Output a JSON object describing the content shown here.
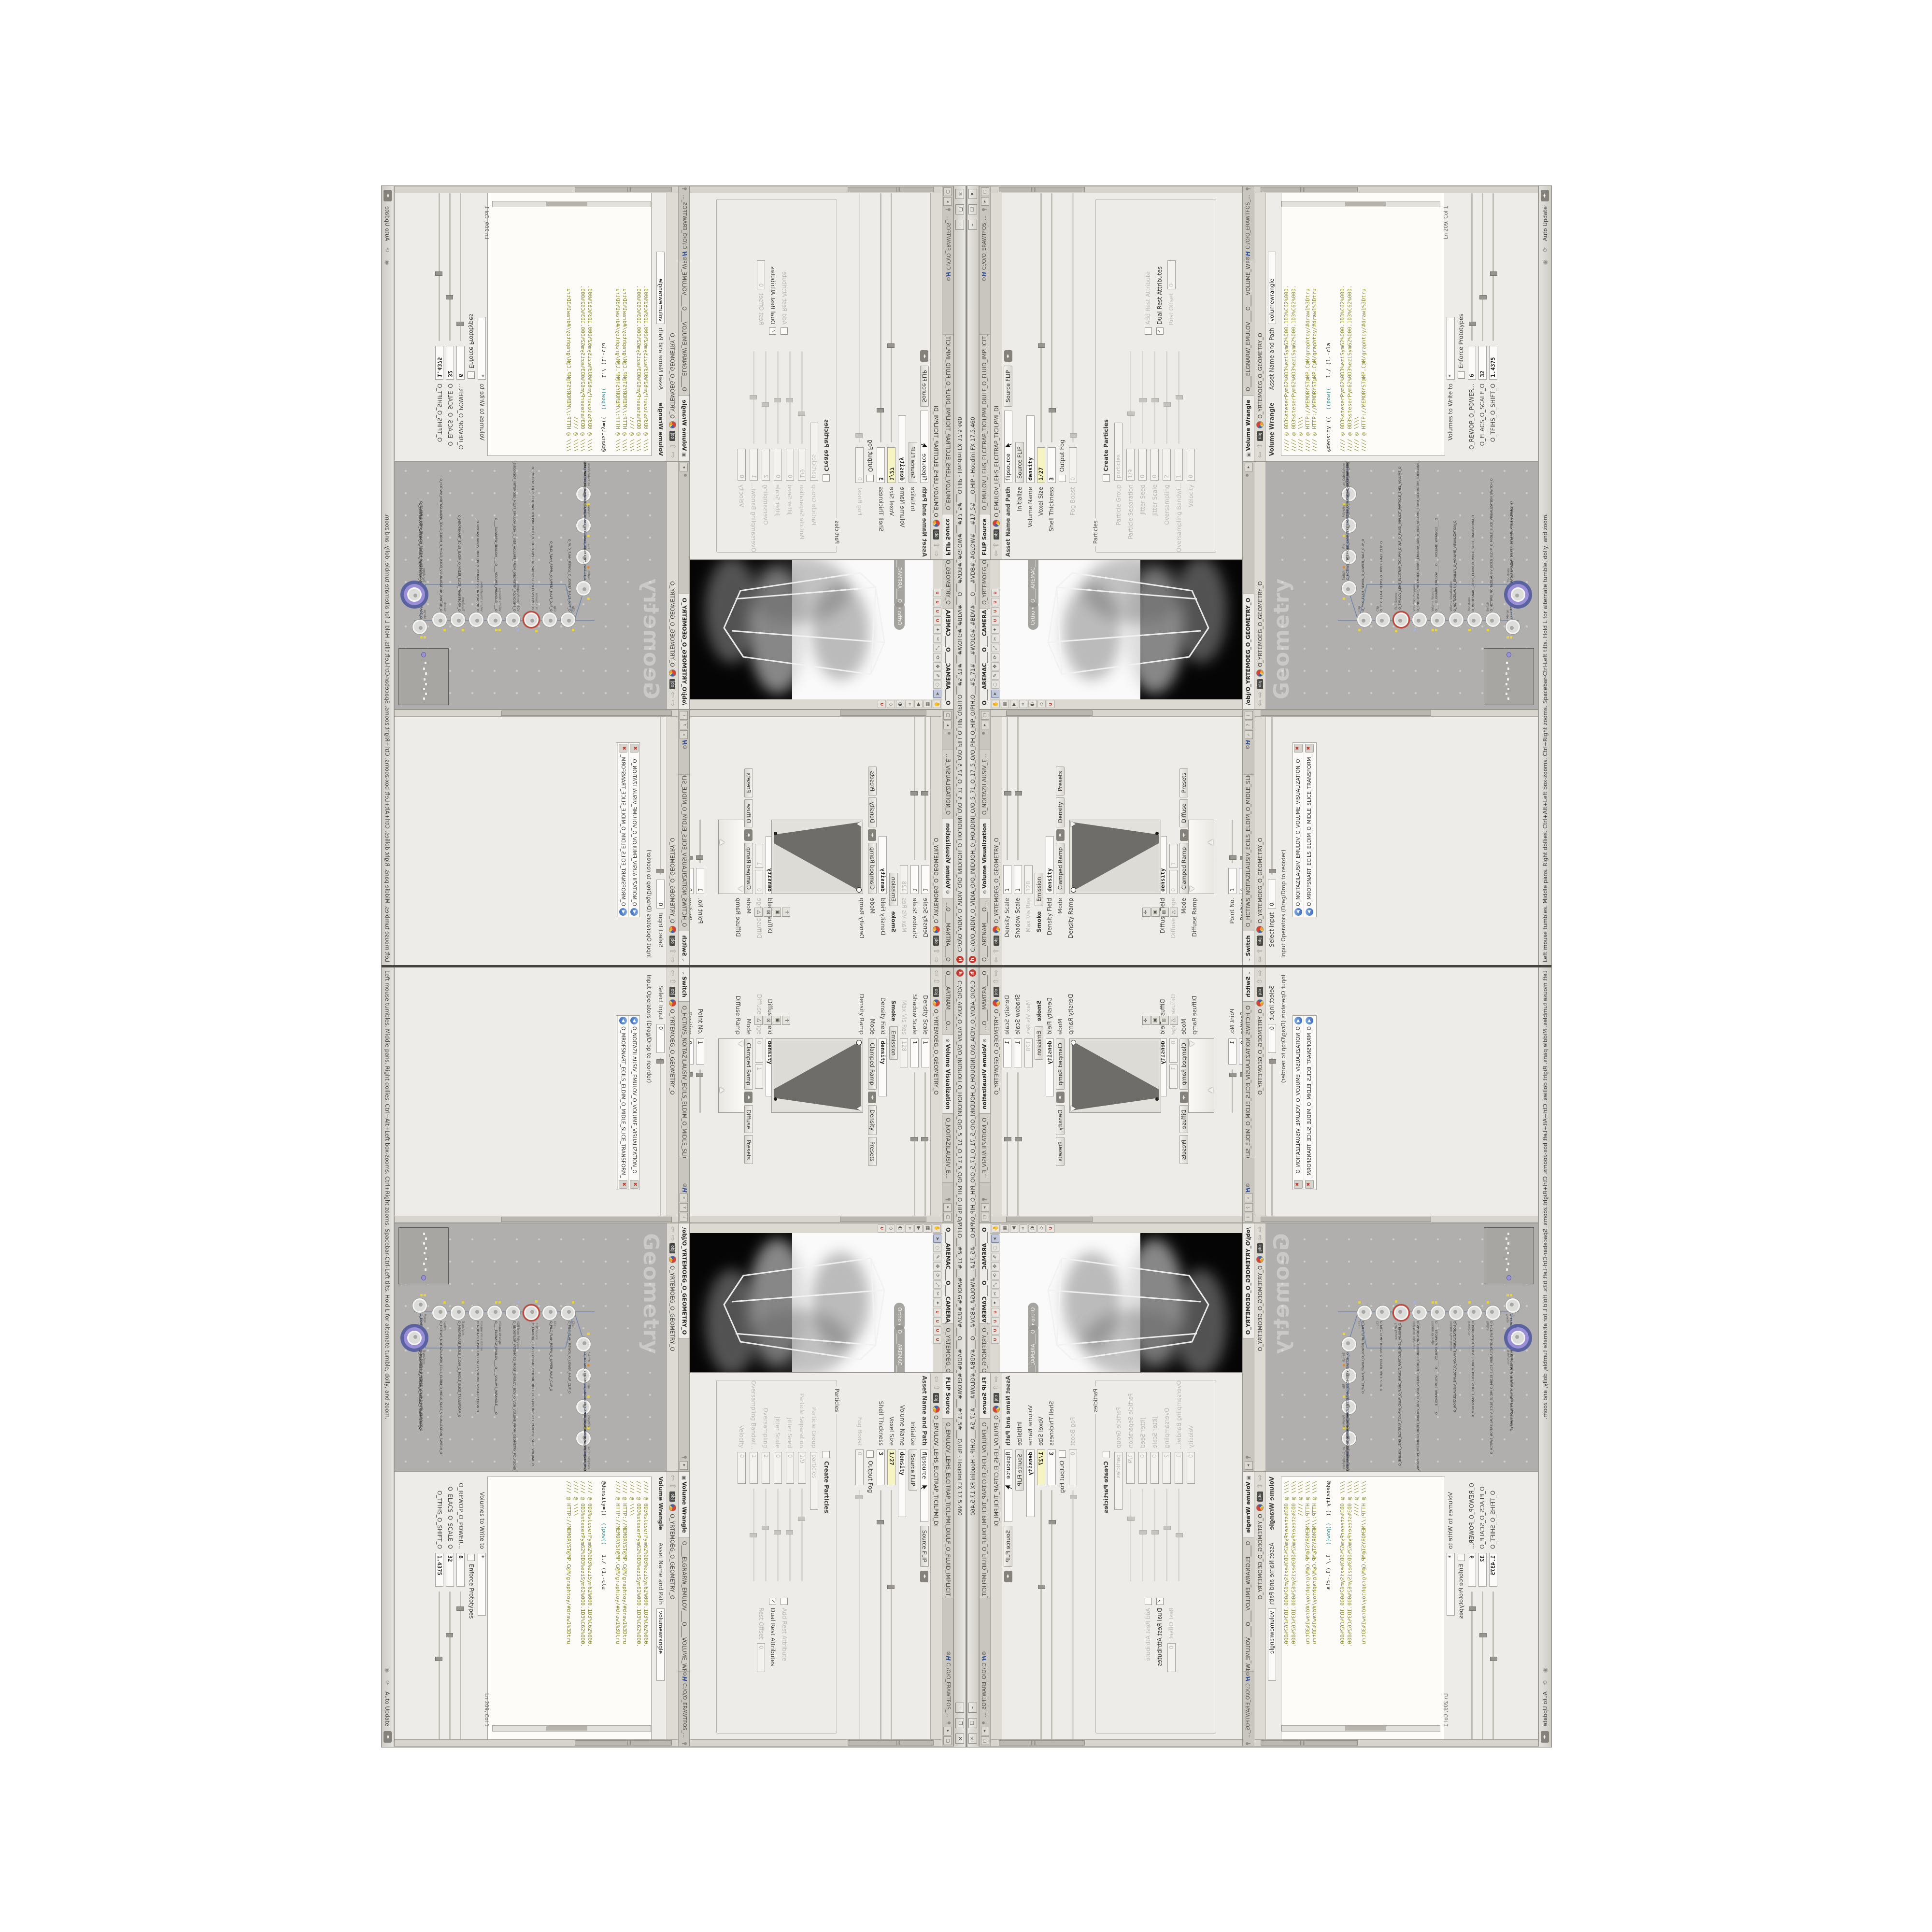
{
  "window": {
    "title": "C:/O/O_AIDIV_O_VIDIA_O/O_INIDUOH_O_HOUDINI_O/O_5_71_O_17_5_O/O_PIH_O_HIP_O/PIH.O___#5_71#___#WOLG#_#BDV#___O___#VDB#_#GLOW#___#17_5#___O.HIP - Houdini FX 17.5.460",
    "minimize": "–",
    "maximize": "❐",
    "close": "✕",
    "app_initial": "h"
  },
  "statusbar": {
    "hint": "Left mouse tumbles. Middle pans. Right dollies. Ctrl+Alt+Left box-zooms. Ctrl+Right zooms. Spacebar-Ctrl-Left tilts. Hold L for alternate tumble, dolly, and zoom.",
    "auto_update": "Auto Update"
  },
  "software_path": "C:/O/O_ERAWTFOS_...",
  "flip": {
    "tab": "FLIP Source",
    "tab2": "O_EMULOV_LEHS_ELCITRAP_TICILPMI_DIULF_O_FLUID_IMPLICIT_PARTICLE_SHEL_VOLUME_O",
    "ctx": "obj",
    "node": "O_EMULOV_LEHS_ELCITRAP_TICILPMI_DI",
    "asset_label": "Asset Name and Path",
    "asset_name": "flipsource",
    "asset_type": "Source FLIP",
    "rows": {
      "initialize": {
        "label": "Initialize",
        "value": "Source FLIP"
      },
      "volume_name": {
        "label": "Volume Name",
        "value": "density"
      },
      "voxel_size": {
        "label": "Voxel Size",
        "value": "1/27"
      },
      "shell_thickness": {
        "label": "Shell Thickness",
        "value": "3"
      },
      "output_fog": {
        "label": "Output Fog"
      },
      "fog_boost": {
        "label": "Fog Boost",
        "value": "0"
      }
    },
    "particles": {
      "title": "Particles",
      "create": "Create Particles",
      "group": {
        "label": "Particle Group",
        "value": "particles"
      },
      "separation": {
        "label": "Particle Separation",
        "value": "1/9"
      },
      "jitter_seed": {
        "label": "Jitter Seed",
        "value": "0"
      },
      "jitter_scale": {
        "label": "Jitter Scale",
        "value": "0"
      },
      "oversampling": {
        "label": "Oversampling",
        "value": "2"
      },
      "oversampling_bw": {
        "label": "Oversampling Bandwi...",
        "value": "1"
      },
      "velocity": {
        "label": "Velocity",
        "value": "0"
      },
      "rest_offset": {
        "label": "Rest Offset",
        "value": "0"
      },
      "add_rest": "Add Rest Attribute",
      "dual_rest": "Dual Rest Attributes"
    }
  },
  "viewport": {
    "tab": "O____AREMAC____O____CAMERA____O...",
    "tab2": "O_YRTEMOEG_O_GEOMETRY_O",
    "ortho_pill": "Ortho ▾",
    "cam_pill": "O____AREMAC____O..."
  },
  "volviz": {
    "tab_prev": "O____ARTNAM____O...",
    "tab": "Volume Visualization",
    "tab_next": "O_NOITAZILAUSIV_E...",
    "ctx": "obj",
    "node": "O_YRTEMOEG_O_GEOMETRY_O",
    "density_scale": {
      "label": "Density Scale",
      "value": "1"
    },
    "shadow_scale": {
      "label": "Shadow Scale",
      "value": "1"
    },
    "max_vis_res": {
      "label": "Max Vis Res",
      "value": "128"
    },
    "folder_tabs": {
      "smoke": "Smoke",
      "emission": "Emission"
    },
    "density_field": {
      "label": "Density Field",
      "value": "density"
    },
    "mode1": {
      "label": "Mode",
      "value": "Clamped Ramp",
      "chan": "Density",
      "presets": "Presets"
    },
    "density_ramp_label": "Density Ramp",
    "diffuse_field": {
      "label": "Diffuse Field",
      "value": "density"
    },
    "diffuse_range": {
      "label": "Diffuse Range",
      "v0": "0",
      "v1": "1"
    },
    "mode2": {
      "label": "Mode",
      "value": "Clamped Ramp",
      "chan": "Diffuse",
      "presets": "Presets"
    },
    "diffuse_ramp_label": "Diffuse Ramp",
    "point_no": {
      "label": "Point No.",
      "value": "1"
    },
    "position": {
      "label": "Position",
      "value": "0"
    },
    "color": {
      "label": "Color",
      "r": "1.8125",
      "g": "1.8125",
      "b": "1.8125"
    },
    "interpolation": {
      "label": "Interpolation",
      "value": "Linear"
    }
  },
  "switch": {
    "tab": "Switch",
    "tab2": "O_HCTIWS_NOITAZILAUSIV_ECILS_ELDIM_O_MIDLE_SLICE_VISUALIZATION_SWITCH_O",
    "ctx": "obj",
    "node": "O_YRTEMOEG_O_GEOMETRY_O",
    "select_input": {
      "label": "Select Input",
      "value": "0"
    },
    "operators_label": "Input Operators (Drag/Drop to reorder)",
    "inputs": [
      "O_NOITAZILAUSIV_EMULOV_O_VOLUME_VISUALIZATION_O",
      "O_MROFSNART_ECILS_ELDIM_O_MIDLE_SLICE_TRANSFORM_O"
    ]
  },
  "network": {
    "tab": "/obj/O_YRTEMOEG_O_GEOMETRY_O",
    "ctx": "obj",
    "node": "O_YRTEMOEG_O_GEOMETRY_O",
    "watermark": "Geometry",
    "nodes": [
      {
        "type": "an_CubeSphere",
        "name": "O_EREHPS_EBUC_O_CUBE_SPHERE_O"
      },
      {
        "type": "PolyWire",
        "name": "O_EMARFERIW_NOGYLOP_EREHPS_EBUC_O_CUBE_SPHERE_POLYGON_WIREFRAME_O"
      },
      {
        "type": "File",
        "name": "JBO.M03.PETS.TROPXE_O_OEG/GEO_O_EXPORT.STEP.30M.OBJ"
      },
      {
        "type": "Switch",
        "name": "O_HCTIWS_YRTEMOEG_LANRETXE_LANRETNI_O_INTERNAL_EXTERNAL_GEOMETRY_SWITCH_O"
      },
      {
        "type": "Clip",
        "name": "O_PILC_FLAH_REWOL_O_LOWER_HALF_CLIP_O"
      },
      {
        "type": "Clip",
        "name": "O_PILC_FLAH_REPPU_O_UPPER_HALF_CLIP_O"
      },
      {
        "type": "FLIP Source",
        "name": "O_EMULOV_LEHS_ELCITRAP_TICILPMI_DIULF_O_FLUID_IMPLICIT_PARTICLE_SHEL_VOLUME_O"
      },
      {
        "type": "VDB from Polygons",
        "name": "O_SNOGYLOP_YRTEMOEG_MORF_EMULOV_BDV_O_VDB_VOLUME_FROM_GEOMETRY_POLYGONS_O"
      },
      {
        "type": "Volume Wrangle",
        "name": "O____ELGNARW_EMULOV____O____VOLUME_WRANGLE____O"
      },
      {
        "type": "Volume Visualization",
        "name": "O_NOITAZILAUSIV_EMULOV_O_VOLUME_VISUALIZATION_O"
      },
      {
        "type": "Transform",
        "name": "O_MROFSNART_ECILS_ELDIM_O_MIDLE_SLICE_TRANSFORM_O"
      },
      {
        "type": "Switch",
        "name": "O_HCTIWS_NOITAZILAUSIV_ECILS_ELDIM_O_MIDLE_SLICE_VISUALIZATION_SWITCH_O"
      },
      {
        "type": "Merge",
        "name": "O_ECAFRUS_HTIW_EMULOV_EGREM_O_MERGE_VOLUME_WITH_SURFACE_O"
      },
      {
        "type": "Transform",
        "name": "O_MROFSNART_TLUSER_O_RESULT_TRANSFORM_O"
      }
    ]
  },
  "wrangle": {
    "tab": "Volume Wrangle",
    "tab2": "O____ELGNARW_EMULOV____O____VOLUME_WRANGL...",
    "ctx": "obj",
    "node": "O_YRTEMOEG_O_GEOMETRY_O",
    "header_title": "Volume Wrangle",
    "asset_label": "Asset Name and Path",
    "asset_name": "volumewrangle",
    "code_lines": [
      "//// @ 0D3%steserPym62%0D3%eziSym62%000.1D3%C62%000.",
      "//// @ 0D3%steserPym62%0D3%eziSym62%000.1D3%C62%000.",
      "//// @ \\\\\\\\",
      "//// @ HTTP://MEMORYST@MP.C@M/graphtoy/#draw1%3Dtru",
      "//// @ HTTP://MEMORYST@MP.C@M/graphtoy/#draw1%3Dtru"
    ],
    "code_parts": {
      "a": "@density=((",
      "b": "  ((pow((",
      "c": "   1./ (1.-cla"
    },
    "code_lines2": [
      "//// @ 0D3%steserPym62%0D3%eziSym62%000.1D3%C62%000.",
      "//// @ 0D3%steserPym62%0D3%eziSym62%000.1D3%C62%000.",
      "//// @ \\\\\\\\",
      "//// @ HTTP://MEMORYST@MP.C@M/graphtoy/#draw1%3Dtru"
    ],
    "cursor_pos": "Ln 209, Col 1",
    "volumes": {
      "label": "Volumes to Write to",
      "value": "*"
    },
    "enforce": "Enforce Prototypes",
    "spare": [
      {
        "label": "O_REWOP_O_POWER...",
        "value": "6"
      },
      {
        "label": "O_ELACS_O_SCALE_O",
        "value": "32"
      },
      {
        "label": "O_TFIHS_O_SHIFT_O",
        "value": "1.4375"
      }
    ]
  },
  "colors": {
    "chrome": "#d7d4ce",
    "pane_bg": "#edece8",
    "network_bg": "#b1afad",
    "keyed_field": "#f7f4c4",
    "code_comment": "#8b8b2e",
    "code_func": "#2f8f8f",
    "error_ring": "#c44438",
    "display_ring": "#9b8fd8",
    "badge": "#e5d24b"
  }
}
